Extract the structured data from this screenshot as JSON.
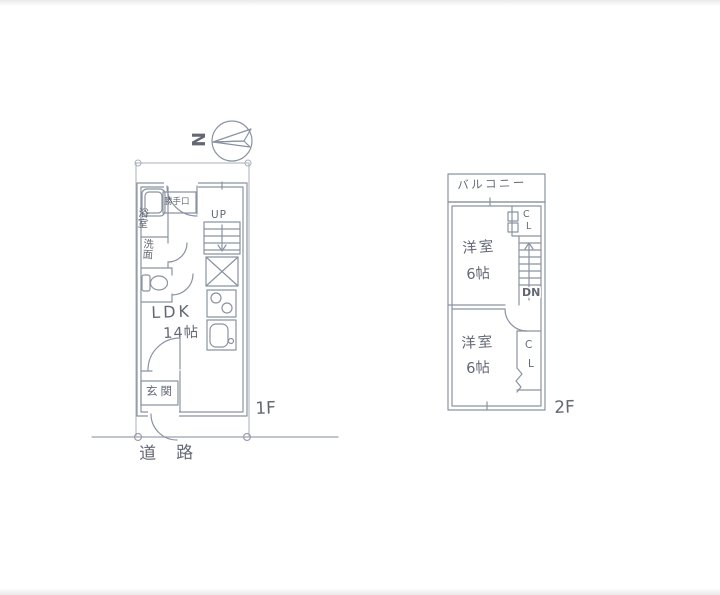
{
  "meta": {
    "description": "Hand-drawn two-storey Japanese floor plan sketch",
    "colors": {
      "ink": "#8b93a1",
      "boundary": "#a9b0ba",
      "text": "#4e5462",
      "paper": "#ffffff"
    }
  },
  "compass": {
    "north": "N"
  },
  "floor1": {
    "label": "1F",
    "road": "道路",
    "ldk": "LDK",
    "ldk_size": "14帖",
    "bath": "浴室",
    "washroom": "洗面",
    "back_door": "勝手口",
    "entrance": "玄関",
    "stairs_up": "UP"
  },
  "floor2": {
    "label": "2F",
    "balcony": "バルコニー",
    "room1": "洋室",
    "room1_size": "6帖",
    "room2": "洋室",
    "room2_size": "6帖",
    "closet1": {
      "c": "C",
      "l": "L"
    },
    "closet2": {
      "c": "C",
      "l": "L"
    },
    "stairs_down": "DN"
  }
}
